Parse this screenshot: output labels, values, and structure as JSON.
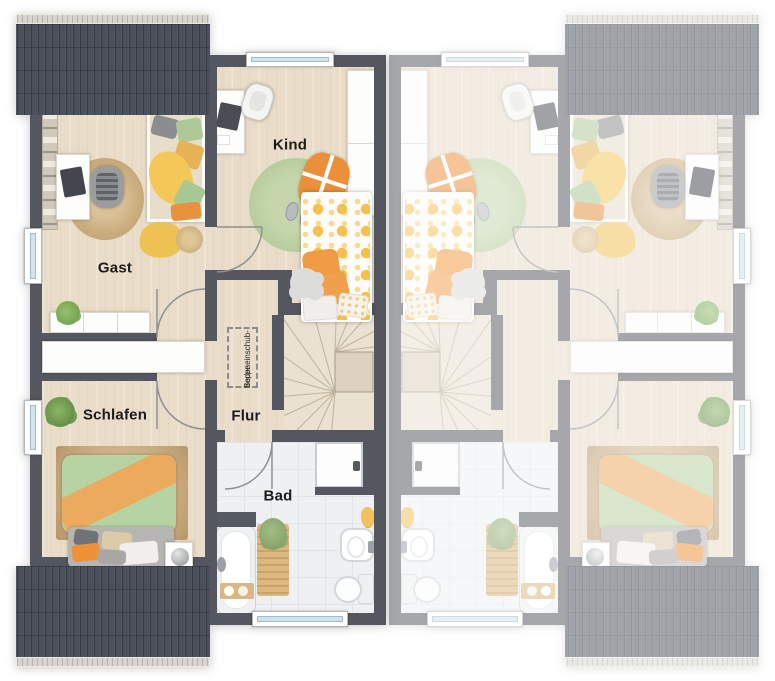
{
  "floorplan": {
    "labels": {
      "gast": "Gast",
      "kind": "Kind",
      "schlafen": "Schlafen",
      "flur": "Flur",
      "bad": "Bad",
      "attic_line1": "Bodeneinschub-",
      "attic_line2": "treppe"
    },
    "colors": {
      "wall_dark": "#54575f",
      "roof": "#4b505d",
      "roof_gutter": "#d9d5cc",
      "floor_wood": "#e9dcc8",
      "floor_bath_tile": "#eef0f2",
      "floor_stairs": "#eae1d1",
      "window_glass": "#cfe3ee",
      "rug_jute": "#c9ad80",
      "rug_green": "#b9d09e",
      "bedding_green": "#b6d3a2",
      "bedding_orange": "#ec9a41",
      "bedding_yellow": "#f4c55c",
      "faded_unit_opacity": 0.52
    }
  }
}
